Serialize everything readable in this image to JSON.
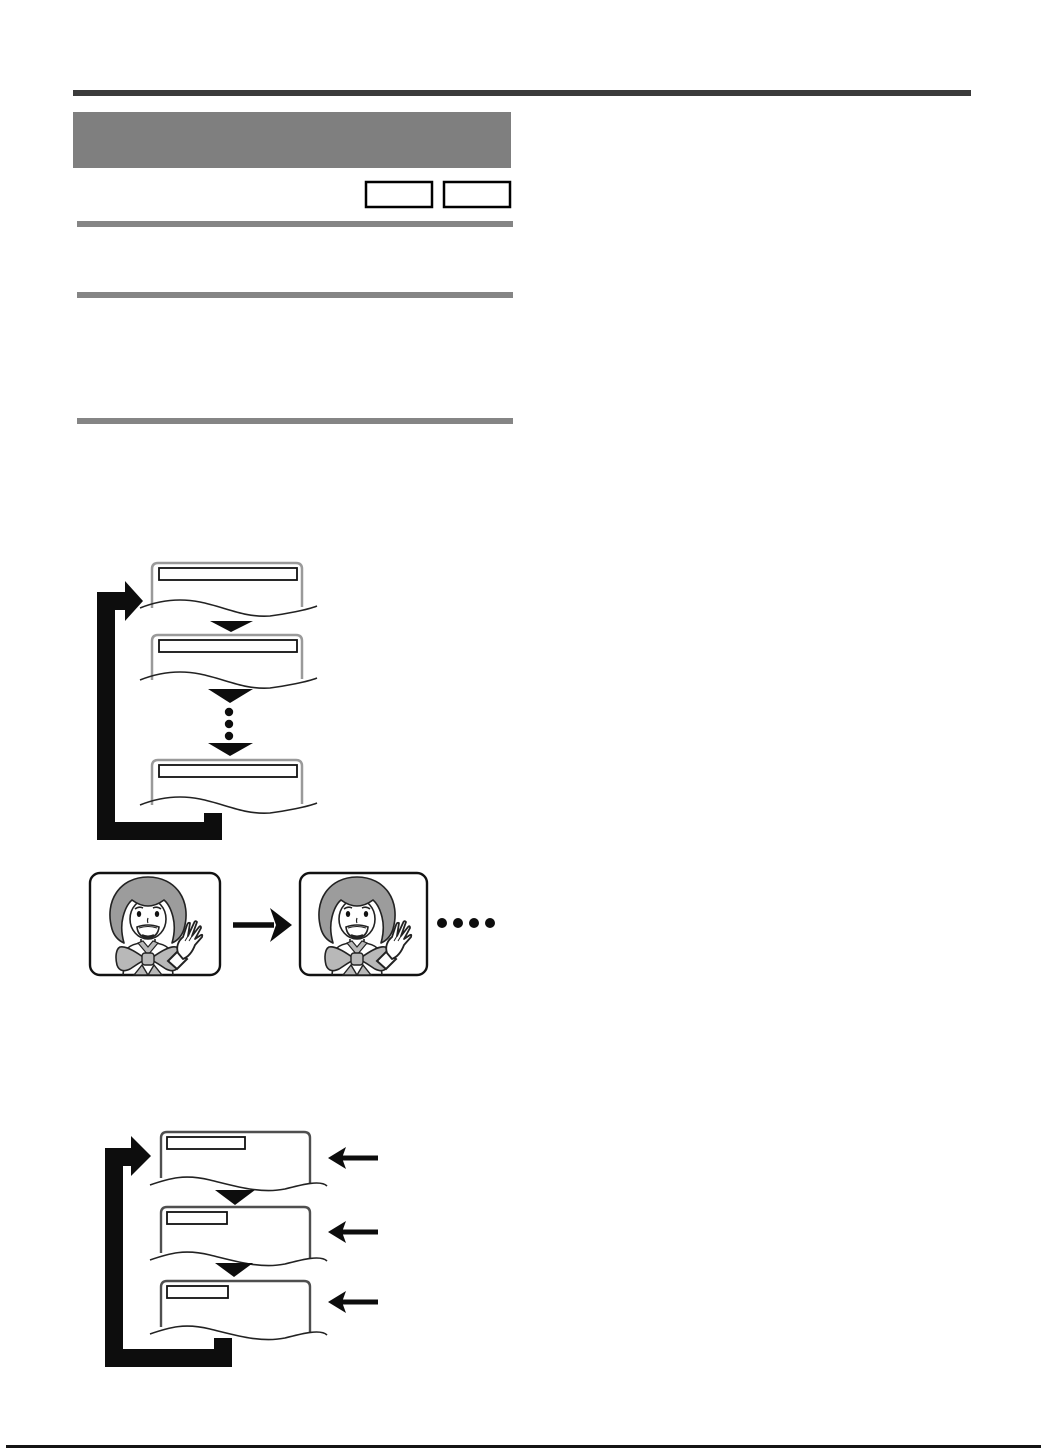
{
  "page": {
    "background": "#ffffff",
    "width_px": 1045,
    "height_px": 1451,
    "description": "Scanned instruction-manual page: gray redacted heading blocks, two blank key boxes, three section bars, and three instructional diagrams with no legible text"
  },
  "colors": {
    "top_rule": "#3b3b3b",
    "header_block": "#7f7f7f",
    "section_bar": "#858585",
    "ink": "#0d0d0d",
    "screen_frame_light": "#9a9a9a",
    "screen_frame_dark": "#4f4f4f",
    "titlebar_stroke": "#111111",
    "hair_gray": "#9c9c9c",
    "bow_gray": "#b8b8b8",
    "bottom_rule": "#141414",
    "white": "#ffffff"
  },
  "header_band": {
    "title_block": "solid gray block, no legible text",
    "key_box_count": 2,
    "section_bar_count": 3
  },
  "figures": {
    "menu_loop": {
      "description": "three torn-edge menu screens cycling via a thick black loop arrow",
      "screen_count": 3,
      "ellipsis_dot_count": 3,
      "icons": [
        "loop-arrow-icon",
        "down-arrowhead-icon",
        "vertical-ellipsis-dots"
      ]
    },
    "repeat_playback": {
      "description": "two identical picture frames of a waving girl, right arrow between, trailing dots after",
      "frame_count": 2,
      "trailing_dot_count": 4,
      "icons": [
        "right-arrow-icon",
        "horizontal-ellipsis-dots",
        "girl-waving-illustration"
      ]
    },
    "menu_loop_with_inputs": {
      "description": "three torn-edge menu screens cycling via loop arrow; a left arrow points into each screen",
      "screen_count": 3,
      "left_arrow_count": 3,
      "icons": [
        "loop-arrow-icon",
        "down-arrowhead-icon",
        "left-arrow-icon"
      ]
    }
  },
  "footer": {
    "rule": "full-width dark hairline"
  }
}
